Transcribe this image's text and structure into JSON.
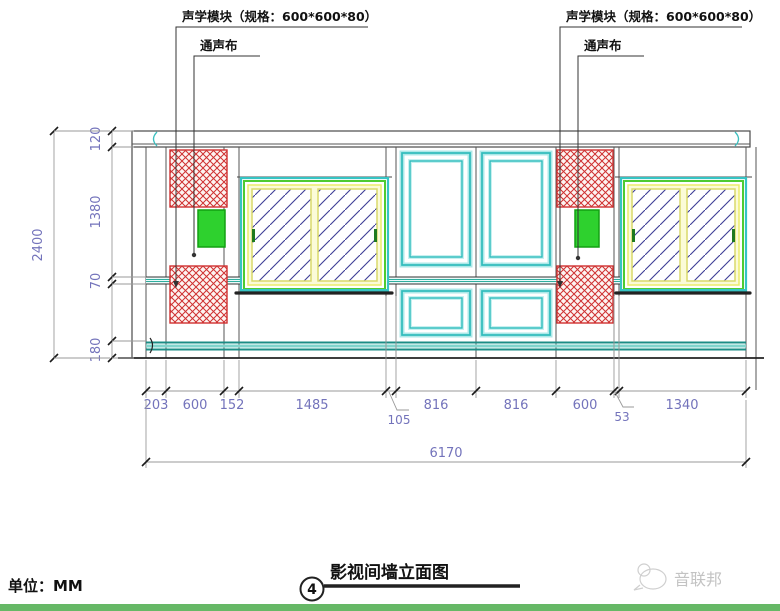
{
  "page": {
    "unit_label": "单位：MM",
    "brand": "音联邦",
    "bottom_bar_color": "#66b866"
  },
  "title_block": {
    "title": "影视间墙立面图",
    "number": "4"
  },
  "annotations": {
    "left": {
      "module": "声学模块（规格：600*600*80）",
      "cloth": "通声布"
    },
    "right": {
      "module": "声学模块（规格：600*600*80）",
      "cloth": "通声布"
    }
  },
  "dimensions": {
    "vertical": {
      "overall": "2400",
      "segments": [
        "120",
        "1380",
        "70",
        "180"
      ]
    },
    "horizontal": {
      "overall": "6170",
      "segments": [
        "203",
        "600",
        "152",
        "1485",
        "816",
        "816",
        "600",
        "1340"
      ],
      "offsets": [
        "105",
        "53"
      ]
    }
  },
  "legend": {
    "hatch_meaning": "声学模块",
    "glass_meaning": "通声布"
  },
  "colors": {
    "hatch_red": "#cf3131",
    "frame_cyan": "#2fbcbc",
    "frame_green": "#4ecb31",
    "frame_yellow": "#ecec6a",
    "glass_blue": "#3d3d95",
    "speaker_green": "#2ed12e",
    "dim_text": "#7373bb"
  }
}
